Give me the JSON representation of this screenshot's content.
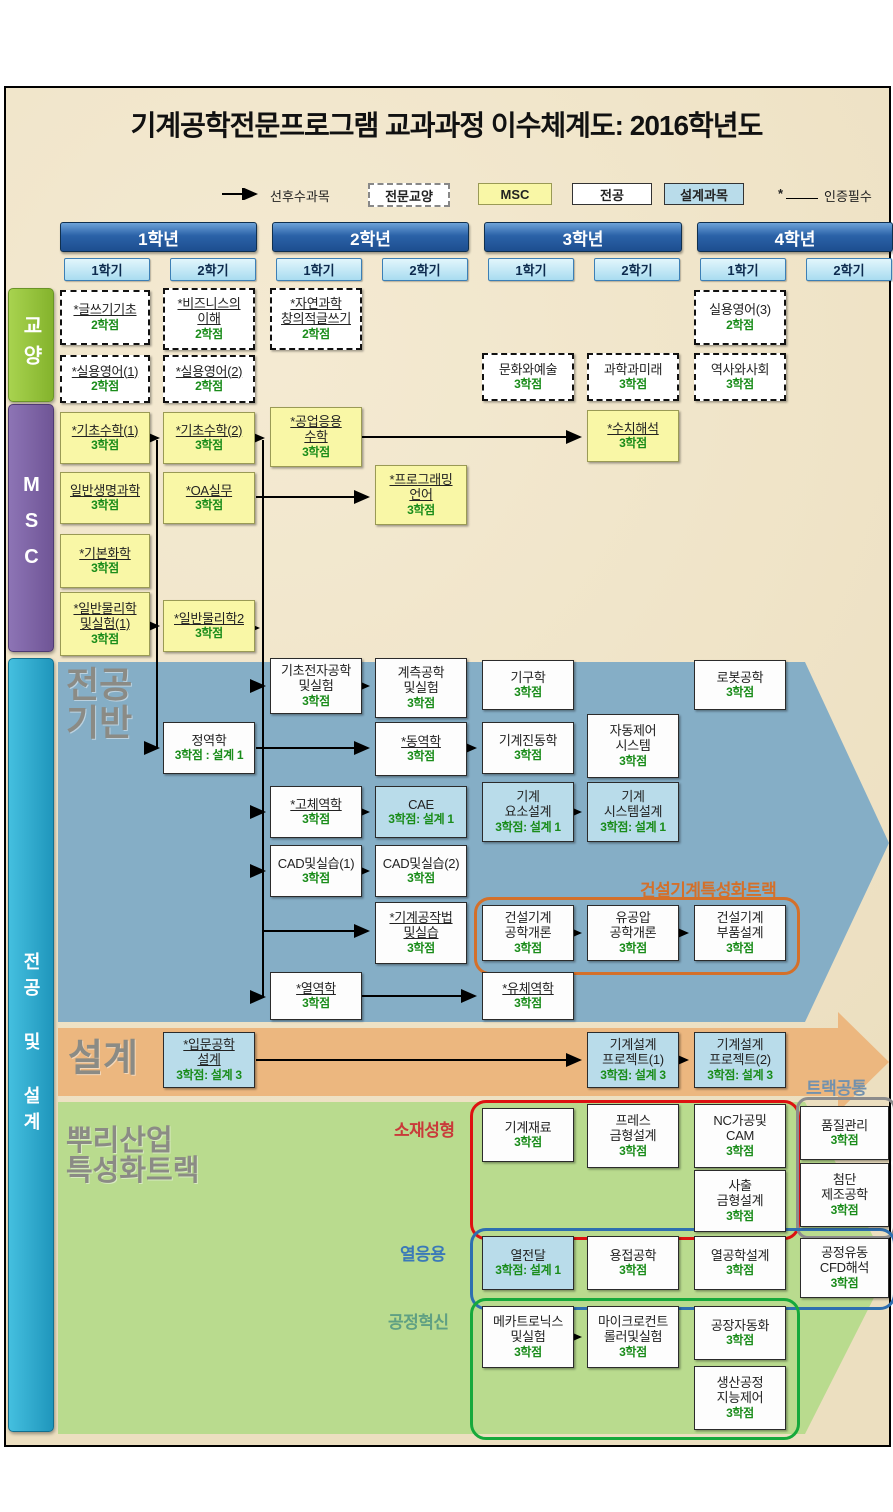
{
  "title": "기계공학전문프로그램 교과과정 이수체계도: 2016학년도",
  "legend": {
    "arrow_label": "선후수과목",
    "items": [
      {
        "label": "전문교양",
        "type": "general"
      },
      {
        "label": "MSC",
        "type": "msc"
      },
      {
        "label": "전공",
        "type": "major"
      },
      {
        "label": "설계과목",
        "type": "design"
      }
    ],
    "cert_symbol": "*",
    "cert_label": "인증필수"
  },
  "years": [
    {
      "label": "1학년"
    },
    {
      "label": "2학년"
    },
    {
      "label": "3학년"
    },
    {
      "label": "4학년"
    }
  ],
  "semesters": [
    "1학기",
    "2학기",
    "1학기",
    "2학기",
    "1학기",
    "2학기",
    "1학기",
    "2학기"
  ],
  "side_sections": [
    {
      "id": "general",
      "label": "교양"
    },
    {
      "id": "msc",
      "label": "MSC"
    },
    {
      "id": "major-design",
      "label": "전공 및 설계"
    }
  ],
  "band_labels": {
    "major_foundation": "전공\n기반",
    "design": "설계",
    "root_track": "뿌리산업\n특성화트랙"
  },
  "group_labels": {
    "construction": "건설기계특성화트랙",
    "track_common": "트랙공통",
    "material": "소재성형",
    "thermal": "열응용",
    "process": "공정혁신"
  },
  "colors": {
    "background": "#eee3c8",
    "year_header": "#2b62a8",
    "semester_header": "#a9dcf0",
    "general_bar": "#8fbe37",
    "msc_bar": "#7a5fa0",
    "major_bar": "#2ca6cc",
    "msc_box": "#f9f7a6",
    "design_box": "#b9dcea",
    "major_band": "#85aec6",
    "design_band": "#ecb77f",
    "root_band": "#b9db8e",
    "credit_green": "#1a8c1a",
    "construction_outline": "#d4702a",
    "material_outline": "#dd1111",
    "thermal_outline": "#2e6fb0",
    "process_outline": "#16a93c",
    "track_common_outline": "#8c8c8c"
  },
  "courses": [
    {
      "id": "g1",
      "name": [
        "*글쓰기기초"
      ],
      "credit": "2학점",
      "type": "general",
      "cert": true
    },
    {
      "id": "g2",
      "name": [
        "*비즈니스의",
        "이해"
      ],
      "credit": "2학점",
      "type": "general",
      "cert": true
    },
    {
      "id": "g3",
      "name": [
        "*자연과학",
        "창의적글쓰기"
      ],
      "credit": "2학점",
      "type": "general",
      "cert": true
    },
    {
      "id": "g4",
      "name": [
        "실용영어(3)"
      ],
      "credit": "2학점",
      "type": "general",
      "cert": false
    },
    {
      "id": "g5",
      "name": [
        "*실용영어(1)"
      ],
      "credit": "2학점",
      "type": "general",
      "cert": true
    },
    {
      "id": "g6",
      "name": [
        "*실용영어(2)"
      ],
      "credit": "2학점",
      "type": "general",
      "cert": true
    },
    {
      "id": "g7",
      "name": [
        "문화와예술"
      ],
      "credit": "3학점",
      "type": "general",
      "cert": false
    },
    {
      "id": "g8",
      "name": [
        "과학과미래"
      ],
      "credit": "3학점",
      "type": "general",
      "cert": false
    },
    {
      "id": "g9",
      "name": [
        "역사와사회"
      ],
      "credit": "3학점",
      "type": "general",
      "cert": false
    },
    {
      "id": "m1",
      "name": [
        "*기초수학(1)"
      ],
      "credit": "3학점",
      "type": "msc",
      "cert": true
    },
    {
      "id": "m2",
      "name": [
        "*기초수학(2)"
      ],
      "credit": "3학점",
      "type": "msc",
      "cert": true
    },
    {
      "id": "m3",
      "name": [
        "*공업응용",
        "수학"
      ],
      "credit": "3학점",
      "type": "msc",
      "cert": true
    },
    {
      "id": "m4",
      "name": [
        "*수치해석"
      ],
      "credit": "3학점",
      "type": "msc",
      "cert": true
    },
    {
      "id": "m5",
      "name": [
        "일반생명과학"
      ],
      "credit": "3학점",
      "type": "msc",
      "cert": true
    },
    {
      "id": "m6",
      "name": [
        "*OA실무"
      ],
      "credit": "3학점",
      "type": "msc",
      "cert": true
    },
    {
      "id": "m7",
      "name": [
        "*프로그래밍",
        "언어"
      ],
      "credit": "3학점",
      "type": "msc",
      "cert": true
    },
    {
      "id": "m8",
      "name": [
        "*기본화학"
      ],
      "credit": "3학점",
      "type": "msc",
      "cert": true
    },
    {
      "id": "m9",
      "name": [
        "*일반물리학",
        "및실험(1)"
      ],
      "credit": "3학점",
      "type": "msc",
      "cert": true
    },
    {
      "id": "m10",
      "name": [
        "*일반물리학2"
      ],
      "credit": "3학점",
      "type": "msc",
      "cert": true
    },
    {
      "id": "p1",
      "name": [
        "기초전자공학",
        "및실험"
      ],
      "credit": "3학점",
      "type": "major",
      "cert": false
    },
    {
      "id": "p2",
      "name": [
        "계측공학",
        "및실험"
      ],
      "credit": "3학점",
      "type": "major",
      "cert": false
    },
    {
      "id": "p3",
      "name": [
        "기구학"
      ],
      "credit": "3학점",
      "type": "major",
      "cert": false
    },
    {
      "id": "p4",
      "name": [
        "로봇공학"
      ],
      "credit": "3학점",
      "type": "major",
      "cert": false
    },
    {
      "id": "p5",
      "name": [
        "정역학"
      ],
      "credit": "3학점 : 설계 1",
      "type": "major",
      "cert": false
    },
    {
      "id": "p6",
      "name": [
        "*동역학"
      ],
      "credit": "3학점",
      "type": "major",
      "cert": true
    },
    {
      "id": "p7",
      "name": [
        "기계진동학"
      ],
      "credit": "3학점",
      "type": "major",
      "cert": false
    },
    {
      "id": "p8",
      "name": [
        "자동제어",
        "시스템"
      ],
      "credit": "3학점",
      "type": "major",
      "cert": false
    },
    {
      "id": "p9",
      "name": [
        "*고체역학"
      ],
      "credit": "3학점",
      "type": "major",
      "cert": true
    },
    {
      "id": "p10",
      "name": [
        "CAE"
      ],
      "credit": "3학점: 설계 1",
      "type": "design",
      "cert": false
    },
    {
      "id": "p11",
      "name": [
        "기계",
        "요소설계"
      ],
      "credit": "3학점: 설계 1",
      "type": "design",
      "cert": false
    },
    {
      "id": "p12",
      "name": [
        "기계",
        "시스템설계"
      ],
      "credit": "3학점: 설계 1",
      "type": "design",
      "cert": false
    },
    {
      "id": "p13",
      "name": [
        "CAD및실습(1)"
      ],
      "credit": "3학점",
      "type": "major",
      "cert": false
    },
    {
      "id": "p14",
      "name": [
        "CAD및실습(2)"
      ],
      "credit": "3학점",
      "type": "major",
      "cert": false
    },
    {
      "id": "p15",
      "name": [
        "*기계공작법",
        "및실습"
      ],
      "credit": "3학점",
      "type": "major",
      "cert": true
    },
    {
      "id": "p16",
      "name": [
        "건설기계",
        "공학개론"
      ],
      "credit": "3학점",
      "type": "major",
      "cert": false
    },
    {
      "id": "p17",
      "name": [
        "유공압",
        "공학개론"
      ],
      "credit": "3학점",
      "type": "major",
      "cert": false
    },
    {
      "id": "p18",
      "name": [
        "건설기계",
        "부품설계"
      ],
      "credit": "3학점",
      "type": "major",
      "cert": false
    },
    {
      "id": "p19",
      "name": [
        "*열역학"
      ],
      "credit": "3학점",
      "type": "major",
      "cert": true
    },
    {
      "id": "p20",
      "name": [
        "*유체역학"
      ],
      "credit": "3학점",
      "type": "major",
      "cert": true
    },
    {
      "id": "d1",
      "name": [
        "*입문공학",
        "설계"
      ],
      "credit": "3학점: 설계 3",
      "type": "design",
      "cert": true
    },
    {
      "id": "d2",
      "name": [
        "기계설계",
        "프로젝트(1)"
      ],
      "credit": "3학점: 설계 3",
      "type": "design",
      "cert": false
    },
    {
      "id": "d3",
      "name": [
        "기계설계",
        "프로젝트(2)"
      ],
      "credit": "3학점: 설계 3",
      "type": "design",
      "cert": false
    },
    {
      "id": "t1",
      "name": [
        "기계재료"
      ],
      "credit": "3학점",
      "type": "major",
      "cert": false
    },
    {
      "id": "t2",
      "name": [
        "프레스",
        "금형설계"
      ],
      "credit": "3학점",
      "type": "major",
      "cert": false
    },
    {
      "id": "t3",
      "name": [
        "NC가공및",
        "CAM"
      ],
      "credit": "3학점",
      "type": "major",
      "cert": false
    },
    {
      "id": "t4",
      "name": [
        "사출",
        "금형설계"
      ],
      "credit": "3학점",
      "type": "major",
      "cert": false
    },
    {
      "id": "t5",
      "name": [
        "품질관리"
      ],
      "credit": "3학점",
      "type": "major",
      "cert": false
    },
    {
      "id": "t6",
      "name": [
        "첨단",
        "제조공학"
      ],
      "credit": "3학점",
      "type": "major",
      "cert": false
    },
    {
      "id": "t7",
      "name": [
        "열전달"
      ],
      "credit": "3학점: 설계 1",
      "type": "design",
      "cert": false
    },
    {
      "id": "t8",
      "name": [
        "용접공학"
      ],
      "credit": "3학점",
      "type": "major",
      "cert": false
    },
    {
      "id": "t9",
      "name": [
        "열공학설계"
      ],
      "credit": "3학점",
      "type": "major",
      "cert": false
    },
    {
      "id": "t10",
      "name": [
        "공정유동",
        "CFD해석"
      ],
      "credit": "3학점",
      "type": "major",
      "cert": false
    },
    {
      "id": "t11",
      "name": [
        "메카트로닉스",
        "및실험"
      ],
      "credit": "3학점",
      "type": "major",
      "cert": false
    },
    {
      "id": "t12",
      "name": [
        "마이크로컨트",
        "롤러및실험"
      ],
      "credit": "3학점",
      "type": "major",
      "cert": false
    },
    {
      "id": "t13",
      "name": [
        "공장자동화"
      ],
      "credit": "3학점",
      "type": "major",
      "cert": false
    },
    {
      "id": "t14",
      "name": [
        "생산공정",
        "지능제어"
      ],
      "credit": "3학점",
      "type": "major",
      "cert": false
    }
  ]
}
